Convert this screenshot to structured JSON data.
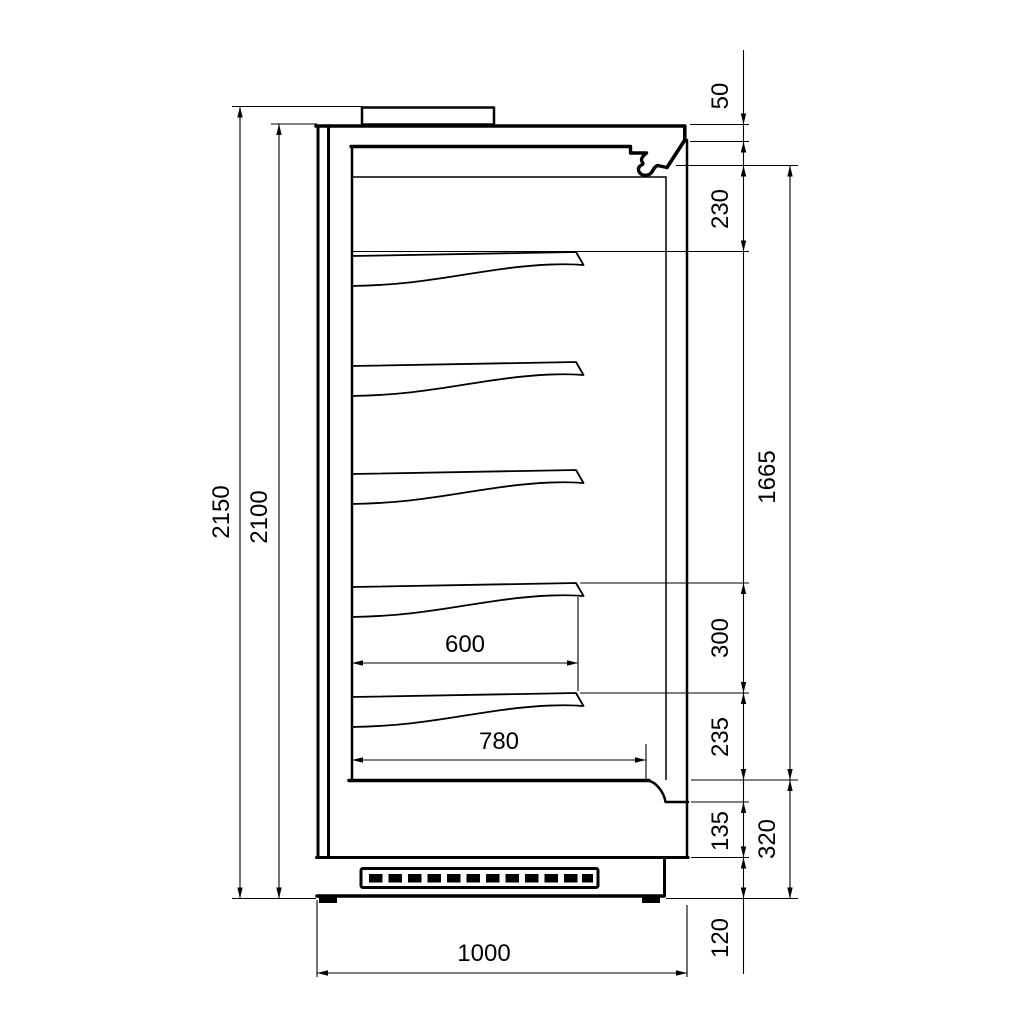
{
  "drawing": {
    "description": "Side cross-section technical drawing of a multideck refrigerated display cabinet with five shelves, top canopy, base with ventilation grille and dimension lines",
    "units": "mm",
    "colors": {
      "line": "#000000",
      "background": "#ffffff"
    },
    "shelf_count": 5,
    "dims": {
      "overall_height": "2150",
      "body_height": "2100",
      "canopy_front_height": "50",
      "top_clearance": "230",
      "interior_height": "1665",
      "shelf_spacing": "300",
      "bottom_clearance": "235",
      "base_front_height": "135",
      "base_total_height": "320",
      "plinth_height": "120",
      "shelf_depth": "600",
      "deck_depth": "780",
      "overall_depth": "1000"
    }
  }
}
